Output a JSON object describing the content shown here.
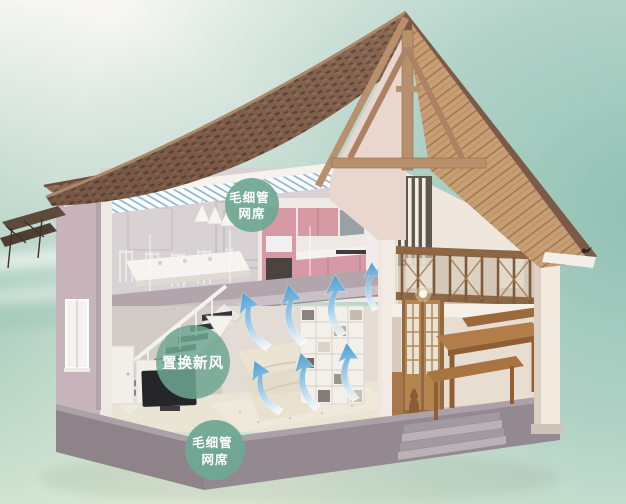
{
  "badges": [
    {
      "id": "capillary-mat-upper",
      "lines": [
        "毛细管",
        "网席"
      ],
      "color": "#6FA893"
    },
    {
      "id": "fresh-air-displacement",
      "lines": [
        "置换新风"
      ],
      "color": "#6FA893"
    },
    {
      "id": "capillary-mat-lower",
      "lines": [
        "毛细管",
        "网席"
      ],
      "color": "#6FA893"
    }
  ],
  "colors": {
    "badge_text": "#FFFFFF",
    "airflow_arrow_blue": "#4F9FD2",
    "capillary_stripe_blue": "#8FB7D0",
    "roof_shingle_brown": "#8D6B55",
    "roof_plank_tan": "#C89F75",
    "wall_mauve": "#C8B5BB",
    "wall_cream": "#EFE7DE",
    "kitchen_pink": "#D79AA4",
    "wood_trim_brown": "#B8906C",
    "foundation_gray": "#948990",
    "background_teal": "#9CC5B8",
    "background_ground": "#EDF2DF"
  }
}
